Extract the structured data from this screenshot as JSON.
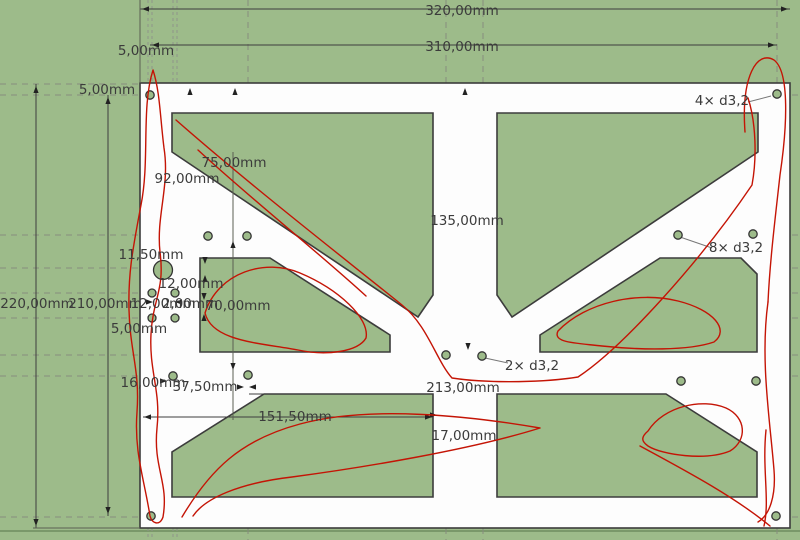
{
  "drawing": {
    "type": "cad-plate-drawing",
    "units": "mm",
    "colors": {
      "background": "#9dbb8a",
      "plate": "#fdfdfd",
      "edge": "#3c3c3c",
      "dimension_text": "#3b3b3b",
      "construction_line": "#878c7d",
      "freehand_sketch": "#c41405"
    },
    "labels": {
      "width_outer": "320,00mm",
      "width_holes": "310,00mm",
      "offset_top_x": "5,00mm",
      "offset_top_y": "5,00mm",
      "holes_corner": "4× d3,2",
      "dim_75": "75,00mm",
      "dim_92": "92,00mm",
      "dim_135": "135,00mm",
      "holes_mid": "8× d3,2",
      "dim_1150": "11,50mm",
      "dim_1200_a": "12,00mm",
      "dim_1200_b": "12,00mm",
      "dim_200": "2,00mm",
      "dim_70": "70,00mm",
      "height_outer": "220,00mm",
      "height_holes": "210,00mm",
      "offset_left": "5,00mm",
      "dim_16": "16,00mm",
      "dim_3750": "37,50mm",
      "dim_15150": "151,50mm",
      "dim_213": "213,00mm",
      "dim_17": "17,00mm",
      "holes_center": "2× d3,2"
    }
  }
}
